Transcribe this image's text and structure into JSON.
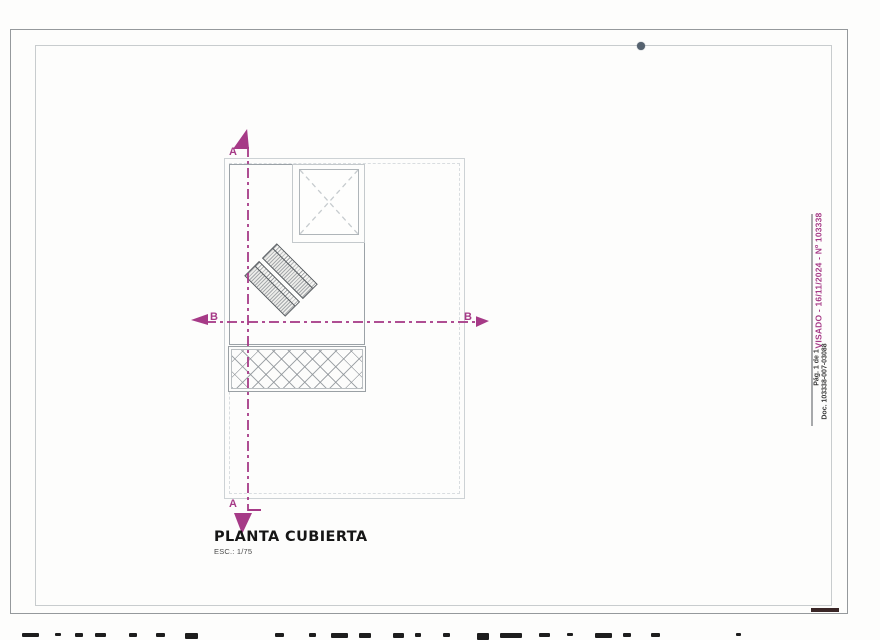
{
  "document": {
    "title": "PLANTA CUBIERTA",
    "scale": "ESC.: 1/75"
  },
  "section_markers": {
    "top": "A",
    "bottom": "A",
    "left": "B",
    "right": "B"
  },
  "stamp": {
    "visado": "VISADO - 16/11/2024 - Nº 103338",
    "page": "Pág. 1 de 1",
    "doc": "Doc. 103338-007-03088"
  },
  "colors": {
    "accent": "#a63a87",
    "ink": "#1d1d1d",
    "line-light": "#c9ced2",
    "line-mid": "#9aa1a6",
    "line-dark": "#565b5f"
  },
  "scan_artifacts": {
    "bottom_marks": [
      {
        "x": 22,
        "w": 17,
        "h": 4
      },
      {
        "x": 55,
        "w": 6,
        "h": 3
      },
      {
        "x": 75,
        "w": 8,
        "h": 4
      },
      {
        "x": 95,
        "w": 11,
        "h": 4
      },
      {
        "x": 129,
        "w": 8,
        "h": 4
      },
      {
        "x": 156,
        "w": 9,
        "h": 4
      },
      {
        "x": 185,
        "w": 13,
        "h": 6
      },
      {
        "x": 275,
        "w": 9,
        "h": 4
      },
      {
        "x": 309,
        "w": 7,
        "h": 4
      },
      {
        "x": 331,
        "w": 17,
        "h": 5
      },
      {
        "x": 359,
        "w": 12,
        "h": 5
      },
      {
        "x": 393,
        "w": 11,
        "h": 5
      },
      {
        "x": 415,
        "w": 6,
        "h": 4
      },
      {
        "x": 443,
        "w": 7,
        "h": 4
      },
      {
        "x": 477,
        "w": 12,
        "h": 7
      },
      {
        "x": 500,
        "w": 22,
        "h": 5
      },
      {
        "x": 539,
        "w": 11,
        "h": 4
      },
      {
        "x": 567,
        "w": 6,
        "h": 3
      },
      {
        "x": 595,
        "w": 17,
        "h": 5
      },
      {
        "x": 623,
        "w": 8,
        "h": 4
      },
      {
        "x": 651,
        "w": 9,
        "h": 4
      },
      {
        "x": 736,
        "w": 5,
        "h": 3
      }
    ]
  }
}
